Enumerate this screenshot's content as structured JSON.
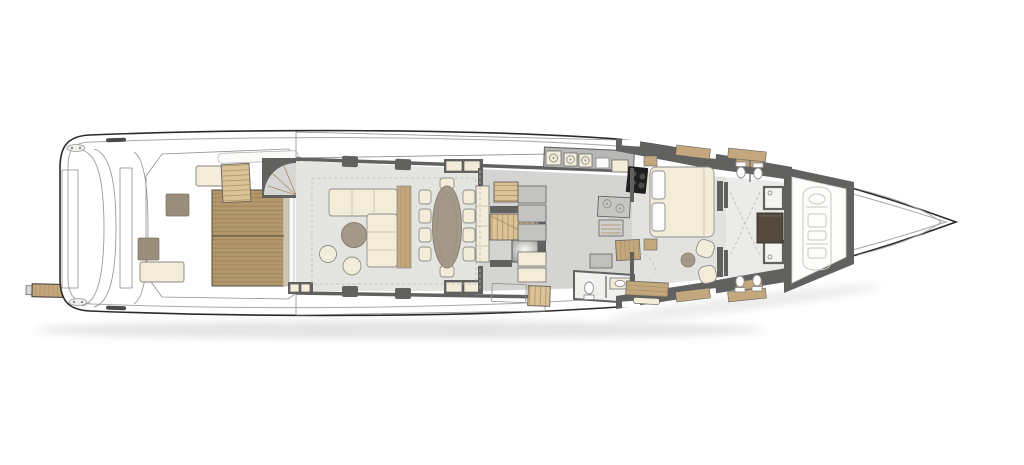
{
  "diagram": {
    "type": "yacht-main-deck-floor-plan",
    "orientation": "bow-right-stern-left",
    "regions": [
      "passerelle",
      "swim-platform",
      "aft-deck",
      "cockpit",
      "salon",
      "dining-area",
      "lobby-staircase",
      "galley",
      "pantry",
      "lift",
      "day-head",
      "port-side-deck",
      "starboard-side-deck",
      "master-cabin",
      "master-bathroom-port",
      "master-bathroom-starboard",
      "wardrobe",
      "tender-garage",
      "bow"
    ],
    "furniture_counts": {
      "sun_loungers": 2,
      "deck_tables": 2,
      "sofas": 1,
      "poufs": 2,
      "coffee_tables": 1,
      "dining_chairs": 10,
      "dining_tables": 1,
      "beds": 1,
      "armchairs": 2,
      "side_tables": 1,
      "desks": 1,
      "toilets": 5,
      "sinks": 2,
      "showers": 2,
      "tenders": 1
    }
  },
  "colors": {
    "hull_white": "#ffffff",
    "outline": "#2b2b2b",
    "inner_line": "#a8a8a6",
    "teak": "#c4a77c",
    "teak_dark": "#b3976c",
    "plank_line": "#a2875c",
    "wood_stair": "#dcc397",
    "stair_line": "#aa8f61",
    "floor_salon": "#e4e4e1",
    "floor_galley": "#d4d4d2",
    "floor_master": "#e2e2df",
    "floor_bath": "#ebebe9",
    "counter": "#b7b7b5",
    "wall": "#616160",
    "wall_light": "#8f8f8d",
    "cream": "#f2ecd9",
    "cream_line": "#c6bfa6",
    "taupe": "#a49889",
    "taupe_dark": "#8b7f72",
    "brown": "#55493e",
    "black": "#1f1f1f",
    "fixture": "#fdfdfd",
    "fixture_line": "#8f8f8d",
    "tender_line": "#c8c8c6",
    "glass": "#f8f8f6",
    "shadow": "#cfcfcd"
  }
}
